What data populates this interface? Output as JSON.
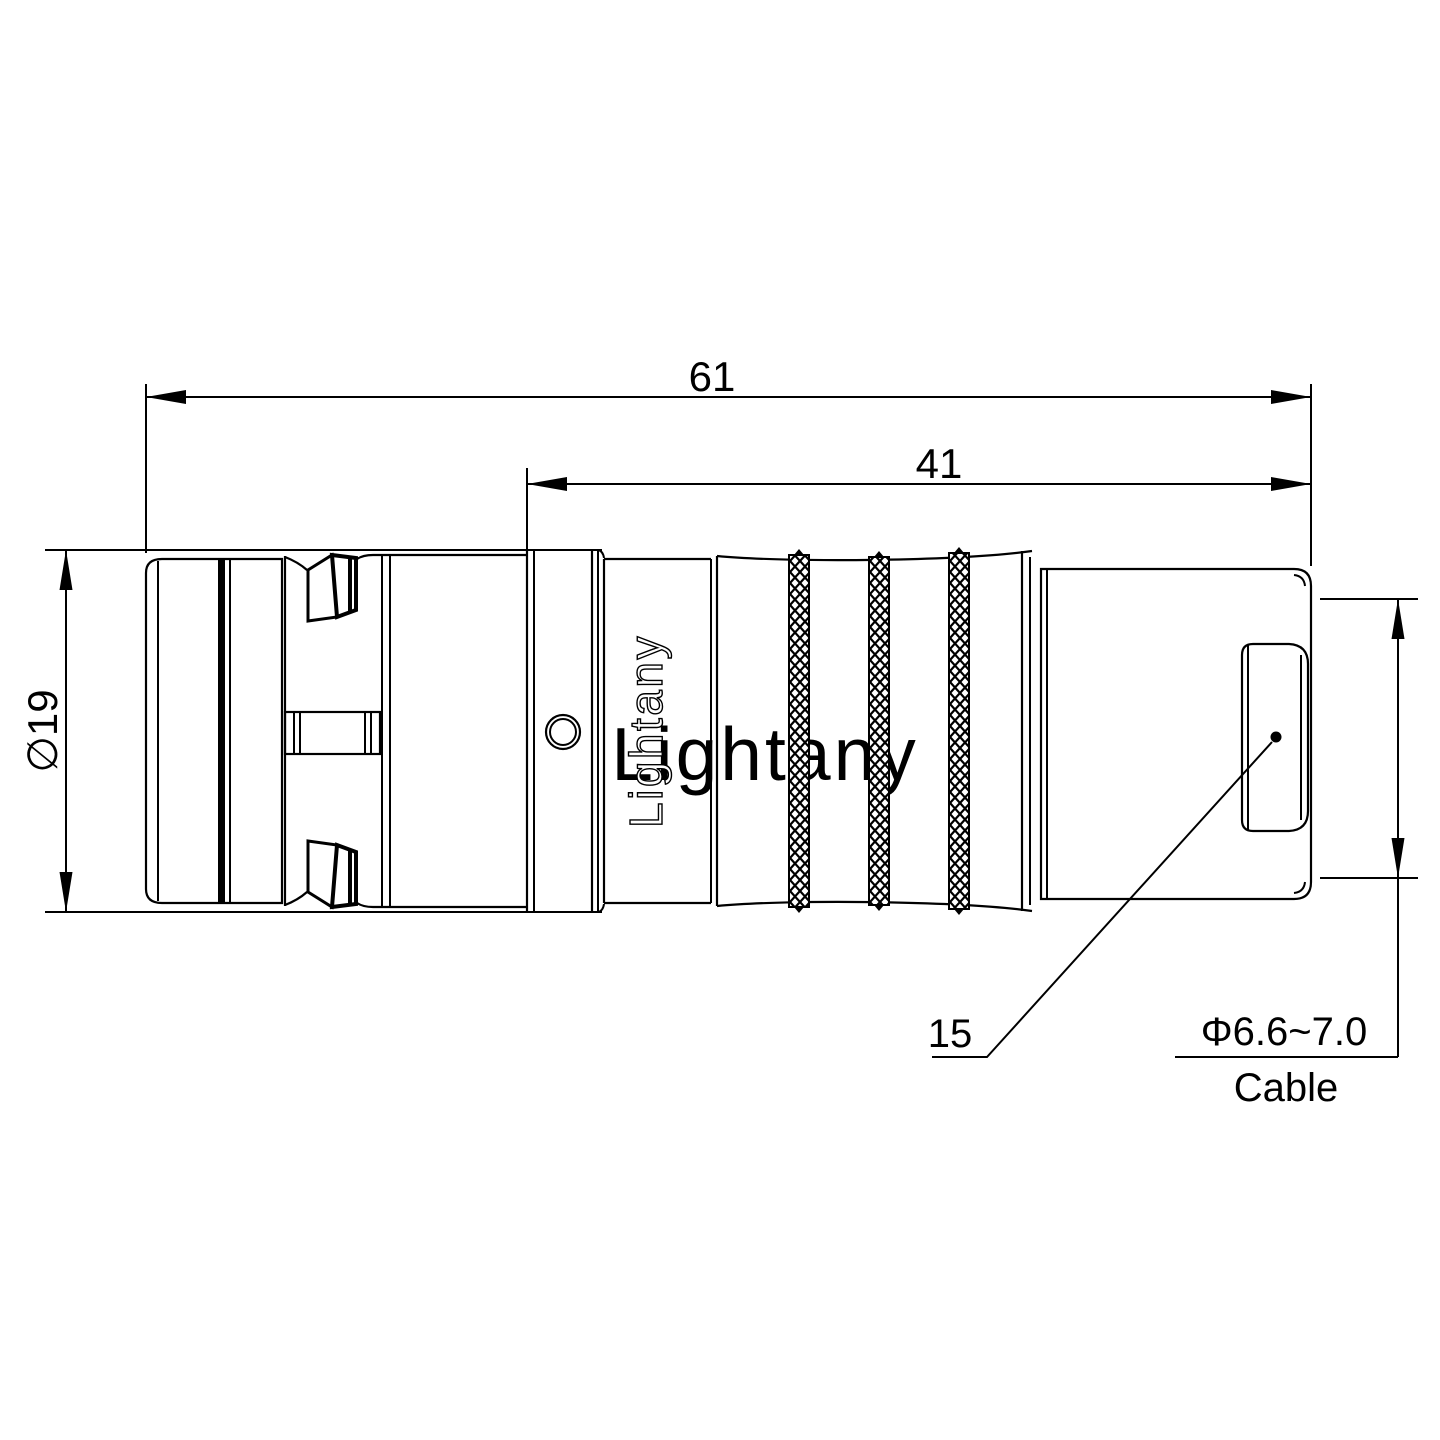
{
  "drawing": {
    "watermark_text": "Lightany",
    "engraving_text": "Lightany",
    "dimensions": {
      "overall_length": "61",
      "rear_length": "41",
      "shell_diameter": "∅19",
      "nut_size": "15",
      "cable_range": "Φ6.6~7.0",
      "cable_word": "Cable"
    },
    "colors": {
      "line": "#000000",
      "background": "#ffffff",
      "watermark_pink": "#efa5a2"
    }
  }
}
